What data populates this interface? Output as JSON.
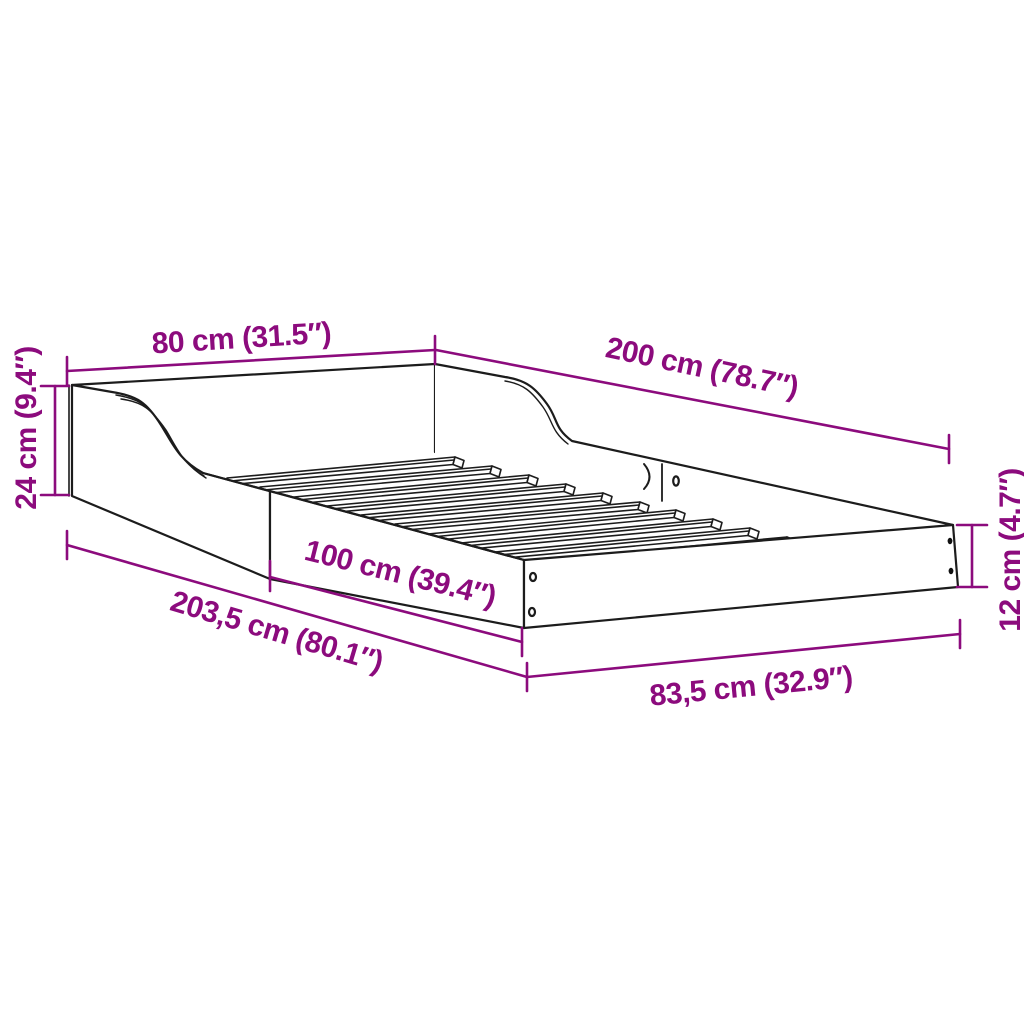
{
  "figure": {
    "type": "product-dimension-diagram",
    "subject": "bed-frame with slatted base, headboard and low side rails",
    "colors": {
      "dimension": "#8C0B7D",
      "line": "#1c1c1c",
      "background": "#ffffff"
    },
    "labels": {
      "headboard_width": "80 cm (31.5″)",
      "bed_length": "200 cm (78.7″)",
      "headboard_height": "24 cm (9.4″)",
      "side_rail_section_length": "100 cm (39.4″)",
      "total_length": "203,5 cm (80.1″)",
      "total_width": "83,5 cm (32.9″)",
      "side_rail_height": "12 cm (4.7″)"
    }
  }
}
